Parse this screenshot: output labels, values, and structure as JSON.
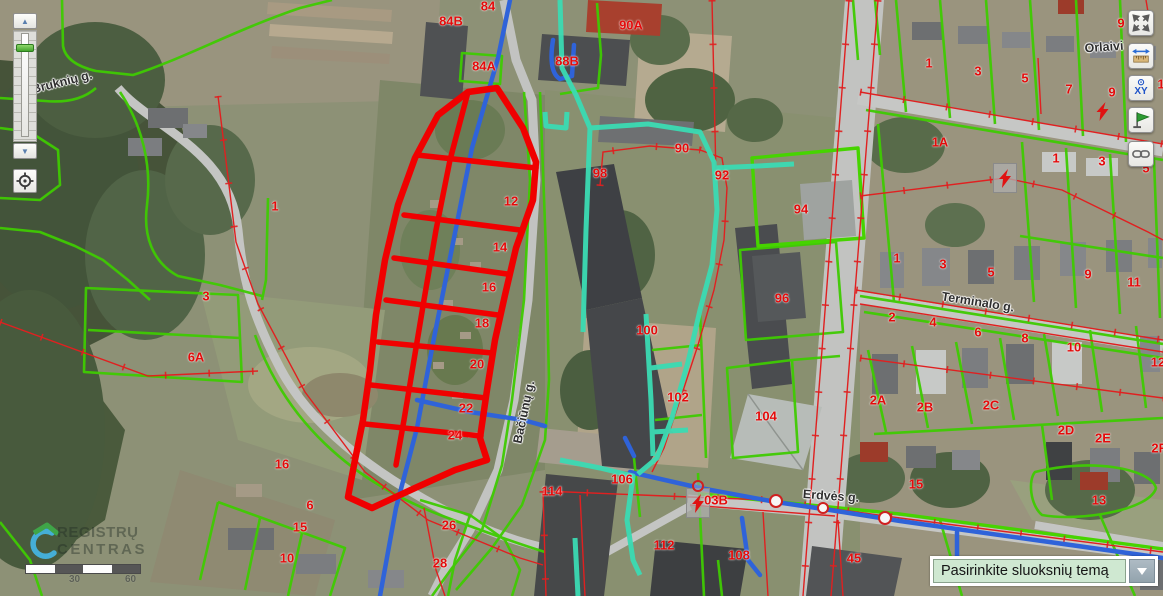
{
  "app": {
    "title": "REGIA map viewer"
  },
  "controls": {
    "zoom_slider": {
      "zoom_in_icon": "▲",
      "zoom_out_icon": "▼"
    },
    "locate_button": {
      "icon": "crosshair-target"
    },
    "right_toolbar": [
      {
        "name": "fullscreen",
        "icon": "expand-arrows-icon"
      },
      {
        "name": "measure",
        "icon": "ruler-arrows-icon"
      },
      {
        "name": "coordinates",
        "icon": "xy-target-icon",
        "dot": "⊙",
        "label": "XY"
      },
      {
        "name": "flag",
        "icon": "green-flag-icon"
      },
      {
        "name": "share-link",
        "icon": "chain-link-icon"
      }
    ],
    "layer_dropdown": {
      "value": "Pasirinkite sluoksnių temą"
    },
    "scale_bar": {
      "labels": [
        "30",
        "60"
      ]
    },
    "logo": {
      "line1": "REGISTRŲ",
      "line2": "CENTRAS"
    }
  },
  "map": {
    "street_labels": [
      {
        "text": "Bruknių g.",
        "x": 62,
        "y": 82,
        "rotate": -14
      },
      {
        "text": "Orlaivi",
        "x": 1104,
        "y": 47,
        "rotate": -4
      },
      {
        "text": "Terminalo g.",
        "x": 978,
        "y": 302,
        "rotate": 9
      },
      {
        "text": "Erdvės g.",
        "x": 831,
        "y": 496,
        "rotate": 4
      },
      {
        "text": "Bačiūnų g.",
        "x": 524,
        "y": 412,
        "rotate": -78
      }
    ],
    "parcel_labels": [
      {
        "t": "84",
        "x": 488,
        "y": 6
      },
      {
        "t": "84B",
        "x": 451,
        "y": 21
      },
      {
        "t": "90A",
        "x": 631,
        "y": 25
      },
      {
        "t": "84A",
        "x": 484,
        "y": 66
      },
      {
        "t": "88B",
        "x": 567,
        "y": 61
      },
      {
        "t": "90",
        "x": 682,
        "y": 148
      },
      {
        "t": "98",
        "x": 600,
        "y": 173
      },
      {
        "t": "92",
        "x": 722,
        "y": 175
      },
      {
        "t": "94",
        "x": 801,
        "y": 209
      },
      {
        "t": "96",
        "x": 782,
        "y": 298
      },
      {
        "t": "100",
        "x": 647,
        "y": 330
      },
      {
        "t": "102",
        "x": 678,
        "y": 397
      },
      {
        "t": "104",
        "x": 766,
        "y": 416
      },
      {
        "t": "106",
        "x": 622,
        "y": 479
      },
      {
        "t": "114",
        "x": 552,
        "y": 491
      },
      {
        "t": "112",
        "x": 664,
        "y": 545
      },
      {
        "t": "108",
        "x": 739,
        "y": 555
      },
      {
        "t": "03B",
        "x": 716,
        "y": 500
      },
      {
        "t": "45",
        "x": 854,
        "y": 558
      },
      {
        "t": "15",
        "x": 916,
        "y": 484
      },
      {
        "t": "13",
        "x": 1099,
        "y": 500
      },
      {
        "t": "1",
        "x": 275,
        "y": 206
      },
      {
        "t": "3",
        "x": 206,
        "y": 296
      },
      {
        "t": "6A",
        "x": 196,
        "y": 357
      },
      {
        "t": "16",
        "x": 282,
        "y": 464
      },
      {
        "t": "6",
        "x": 310,
        "y": 505
      },
      {
        "t": "15",
        "x": 300,
        "y": 527
      },
      {
        "t": "10",
        "x": 287,
        "y": 558
      },
      {
        "t": "26",
        "x": 449,
        "y": 525
      },
      {
        "t": "28",
        "x": 440,
        "y": 563
      },
      {
        "t": "12",
        "x": 511,
        "y": 201
      },
      {
        "t": "14",
        "x": 500,
        "y": 247
      },
      {
        "t": "16",
        "x": 489,
        "y": 287
      },
      {
        "t": "18",
        "x": 482,
        "y": 323
      },
      {
        "t": "20",
        "x": 477,
        "y": 364
      },
      {
        "t": "22",
        "x": 466,
        "y": 408
      },
      {
        "t": "24",
        "x": 455,
        "y": 435
      },
      {
        "t": "9",
        "x": 1121,
        "y": 23
      },
      {
        "t": "1",
        "x": 929,
        "y": 63
      },
      {
        "t": "3",
        "x": 978,
        "y": 71
      },
      {
        "t": "5",
        "x": 1025,
        "y": 78
      },
      {
        "t": "7",
        "x": 1069,
        "y": 89
      },
      {
        "t": "9",
        "x": 1112,
        "y": 92
      },
      {
        "t": "1",
        "x": 1161,
        "y": 84
      },
      {
        "t": "1A",
        "x": 940,
        "y": 142
      },
      {
        "t": "1",
        "x": 1056,
        "y": 158
      },
      {
        "t": "3",
        "x": 1102,
        "y": 161
      },
      {
        "t": "5",
        "x": 1146,
        "y": 168
      },
      {
        "t": "1",
        "x": 897,
        "y": 258
      },
      {
        "t": "3",
        "x": 943,
        "y": 264
      },
      {
        "t": "5",
        "x": 991,
        "y": 272
      },
      {
        "t": "9",
        "x": 1088,
        "y": 274
      },
      {
        "t": "11",
        "x": 1134,
        "y": 282
      },
      {
        "t": "2",
        "x": 892,
        "y": 317
      },
      {
        "t": "4",
        "x": 933,
        "y": 322
      },
      {
        "t": "6",
        "x": 978,
        "y": 332
      },
      {
        "t": "8",
        "x": 1025,
        "y": 338
      },
      {
        "t": "10",
        "x": 1074,
        "y": 347
      },
      {
        "t": "12",
        "x": 1158,
        "y": 362
      },
      {
        "t": "2A",
        "x": 878,
        "y": 400
      },
      {
        "t": "2B",
        "x": 925,
        "y": 407
      },
      {
        "t": "2C",
        "x": 991,
        "y": 405
      },
      {
        "t": "2D",
        "x": 1066,
        "y": 430
      },
      {
        "t": "2E",
        "x": 1103,
        "y": 438
      },
      {
        "t": "2F",
        "x": 1159,
        "y": 448
      }
    ],
    "symbols": {
      "substations": [
        {
          "x": 697,
          "y": 502
        },
        {
          "x": 1004,
          "y": 177
        }
      ],
      "bolts": [
        {
          "x": 1103,
          "y": 114
        }
      ],
      "nodes": [
        {
          "x": 776,
          "y": 501,
          "r": 7
        },
        {
          "x": 823,
          "y": 508,
          "r": 6
        },
        {
          "x": 885,
          "y": 518,
          "r": 7
        },
        {
          "x": 698,
          "y": 486,
          "r": 6,
          "ring": true
        }
      ]
    },
    "legend_colors": {
      "parcel_green": "#3fcb02",
      "utility_red": "#e02020",
      "selection_red": "#f00000",
      "water_blue": "#2f63d9",
      "heat_teal": "#3bdbb3"
    }
  }
}
